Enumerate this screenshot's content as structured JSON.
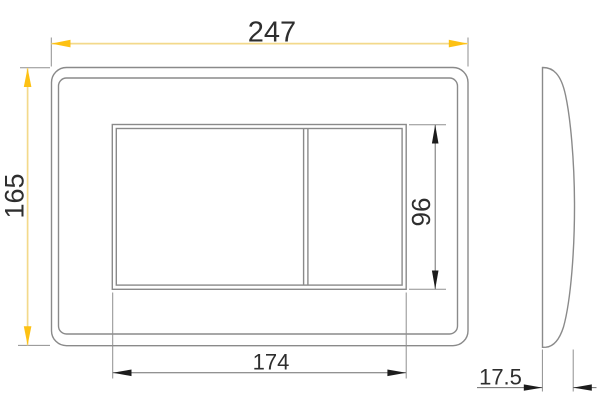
{
  "drawing": {
    "type": "technical-dimension-drawing",
    "views": [
      "front",
      "side"
    ]
  },
  "dimensions": {
    "overall_width": {
      "value": "247"
    },
    "overall_height": {
      "value": "165"
    },
    "cutout_width": {
      "value": "174"
    },
    "cutout_height": {
      "value": "96"
    },
    "depth": {
      "value": "17.5"
    }
  },
  "colors": {
    "background": "#ffffff",
    "outline": "#8a8a8a",
    "dim_line": "#8f8f8f",
    "dim_arrow_black": "#1c1c1c",
    "highlight_line": "#f3d98b",
    "highlight_arrow": "#fdc113",
    "text": "#2e2e2e"
  }
}
